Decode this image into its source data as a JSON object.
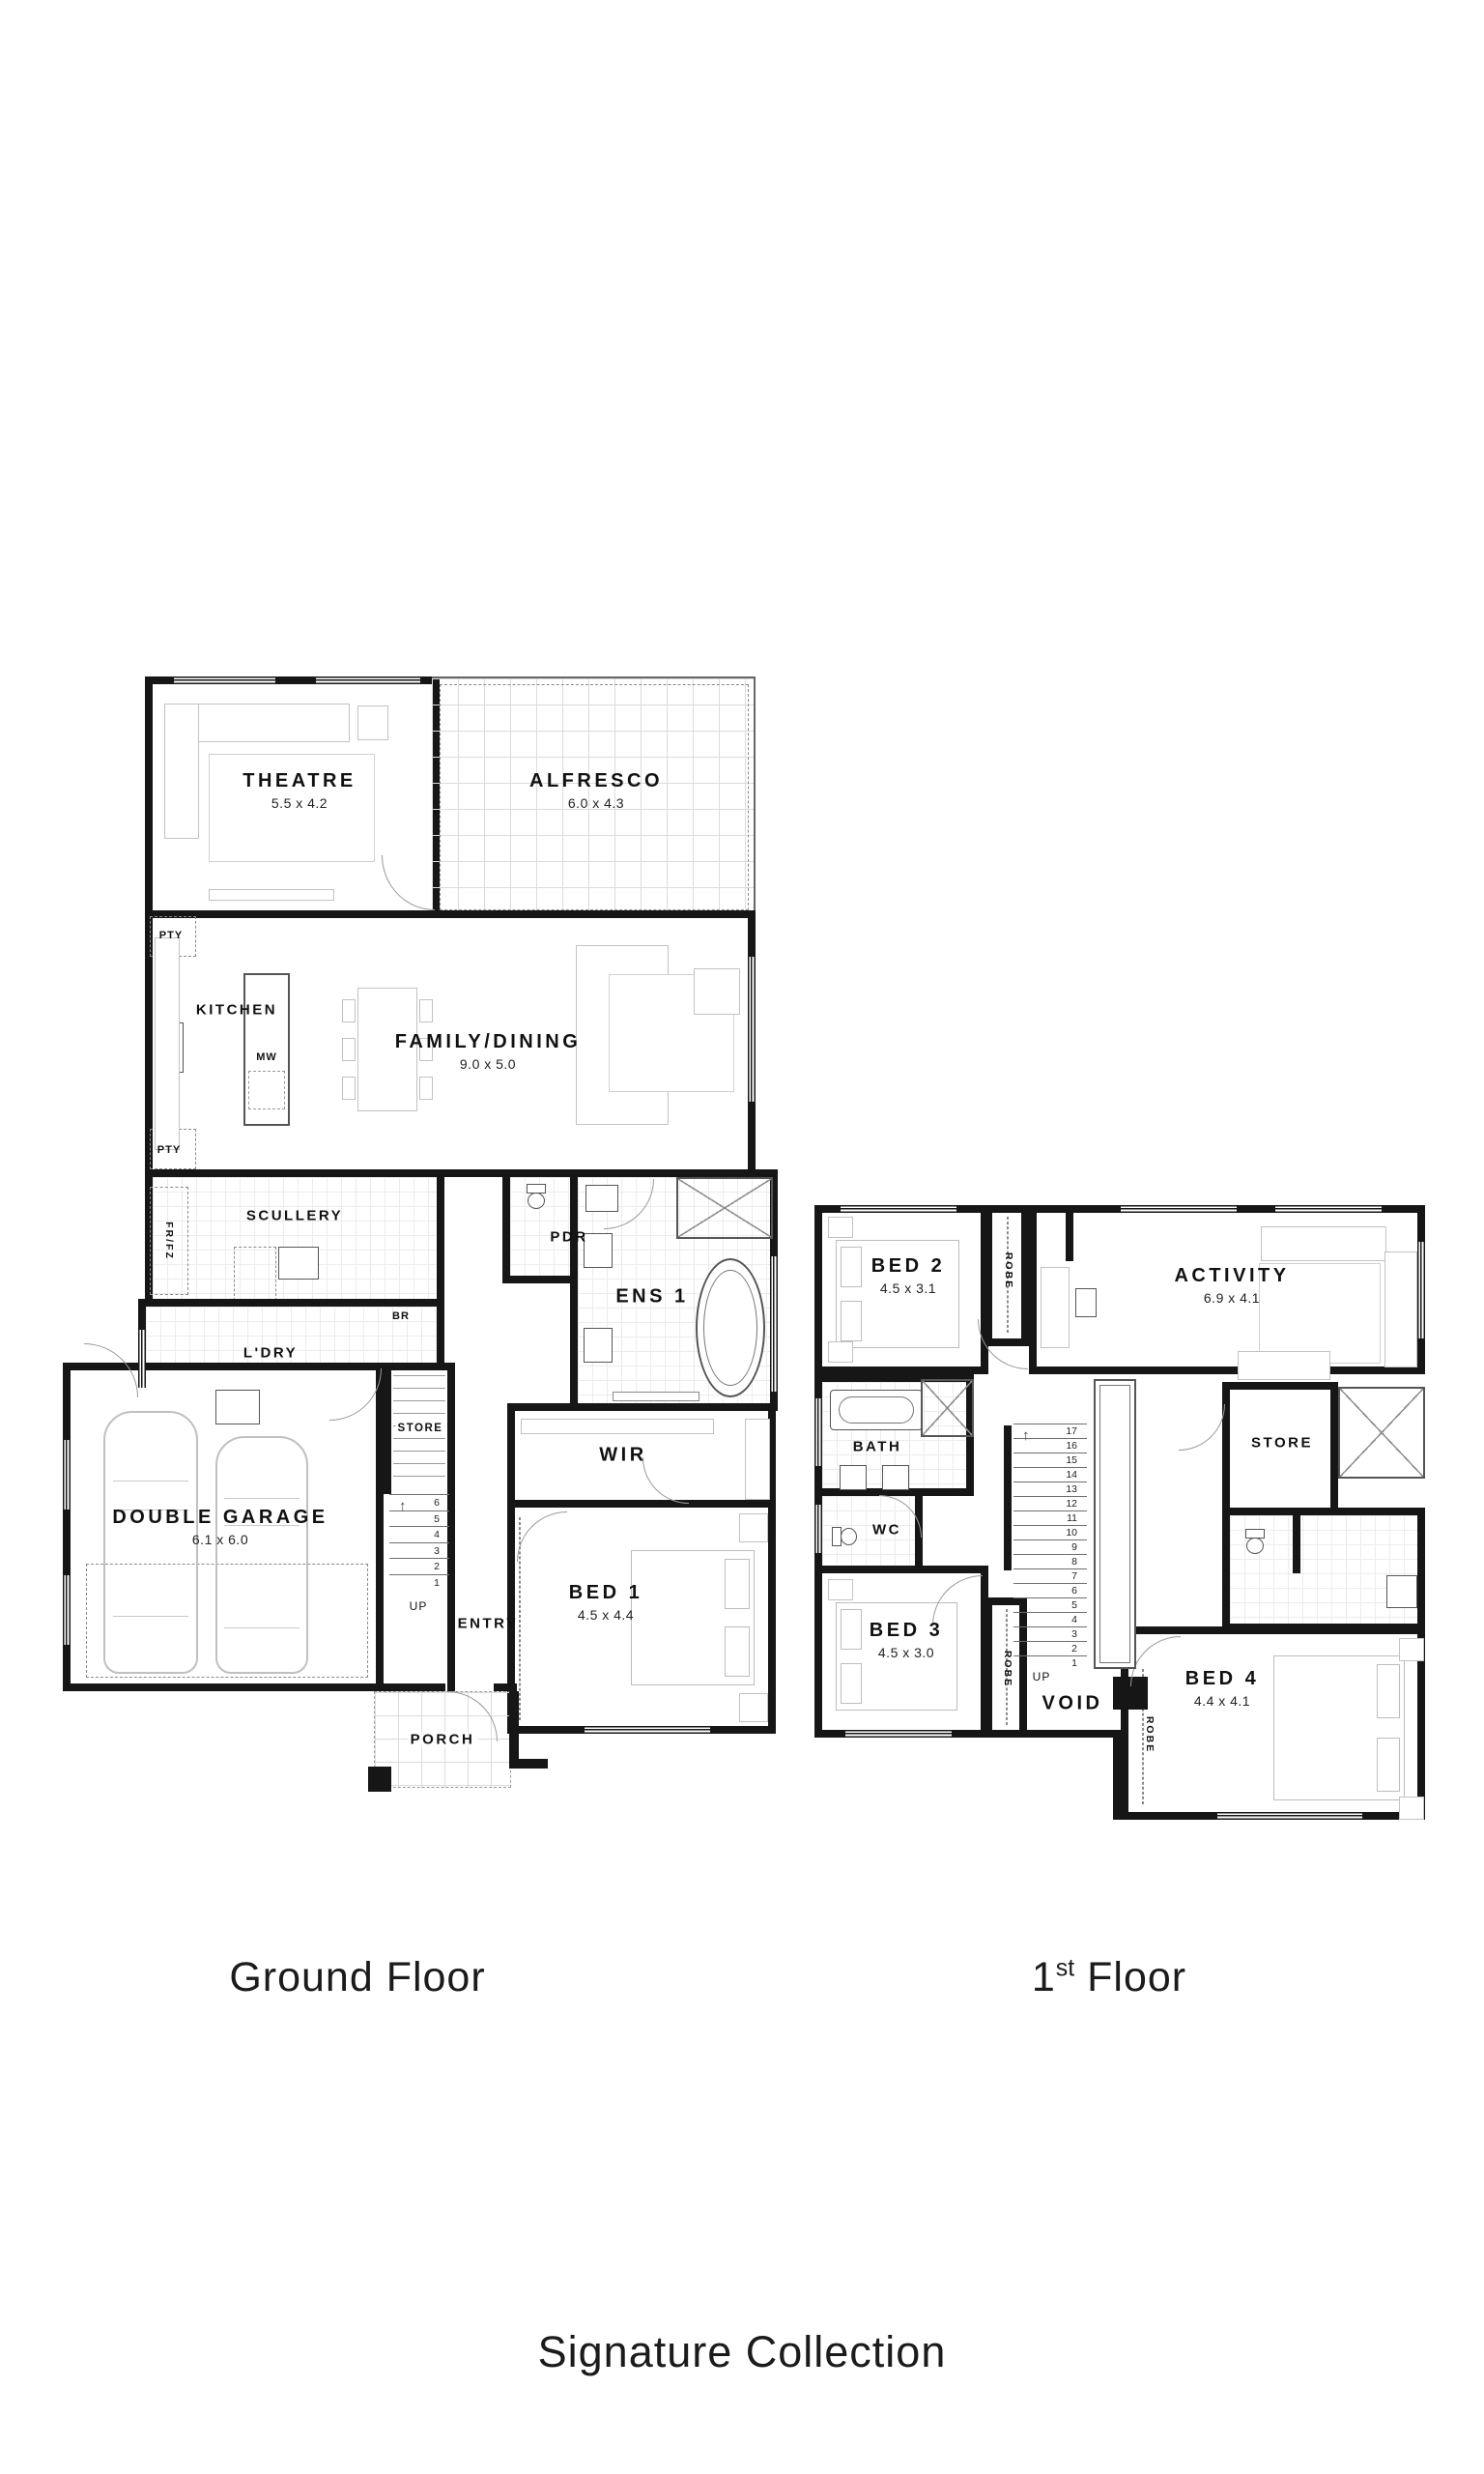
{
  "ground_floor": {
    "label": "Ground Floor",
    "rooms": {
      "theatre": {
        "name": "THEATRE",
        "dims": "5.5 x 4.2"
      },
      "alfresco": {
        "name": "ALFRESCO",
        "dims": "6.0 x 4.3"
      },
      "kitchen": {
        "name": "KITCHEN"
      },
      "family_dining": {
        "name": "FAMILY/DINING",
        "dims": "9.0 x 5.0"
      },
      "scullery": {
        "name": "SCULLERY"
      },
      "laundry": {
        "name": "L'DRY"
      },
      "powder": {
        "name": "PDR"
      },
      "ensuite1": {
        "name": "ENS 1"
      },
      "store": {
        "name": "STORE"
      },
      "entry": {
        "name": "ENTRY"
      },
      "double_garage": {
        "name": "DOUBLE GARAGE",
        "dims": "6.1 x 6.0"
      },
      "wir": {
        "name": "WIR"
      },
      "bed1": {
        "name": "BED 1",
        "dims": "4.5 x 4.4"
      },
      "porch": {
        "name": "PORCH"
      }
    },
    "annotations": {
      "pty_top": "PTY",
      "pty_bottom": "PTY",
      "fridge_freezer": "FR/FZ",
      "microwave": "MW",
      "broom": "BR",
      "up": "UP",
      "stair_numbers": [
        "6",
        "5",
        "4",
        "3",
        "2",
        "1"
      ]
    }
  },
  "first_floor": {
    "label_number": "1",
    "label_ordinal": "st",
    "label_word": "Floor",
    "rooms": {
      "bed2": {
        "name": "BED 2",
        "dims": "4.5 x 3.1"
      },
      "activity": {
        "name": "ACTIVITY",
        "dims": "6.9 x 4.1"
      },
      "bath": {
        "name": "BATH"
      },
      "wc": {
        "name": "WC"
      },
      "store": {
        "name": "STORE"
      },
      "bed3": {
        "name": "BED 3",
        "dims": "4.5 x 3.0"
      },
      "bed4": {
        "name": "BED 4",
        "dims": "4.4 x 4.1"
      },
      "void": {
        "name": "VOID"
      }
    },
    "annotations": {
      "robe_bed2": "ROBE",
      "robe_bed3": "ROBE",
      "robe_bed4": "ROBE",
      "up": "UP",
      "stair_numbers": [
        "17",
        "16",
        "15",
        "14",
        "13",
        "12",
        "11",
        "10",
        "9",
        "8",
        "7",
        "6",
        "5",
        "4",
        "3",
        "2",
        "1"
      ]
    }
  },
  "footer": {
    "collection_label": "Signature Collection"
  },
  "colors": {
    "wall": "#161616",
    "furniture": "#c2c2c2",
    "background": "#ffffff"
  }
}
